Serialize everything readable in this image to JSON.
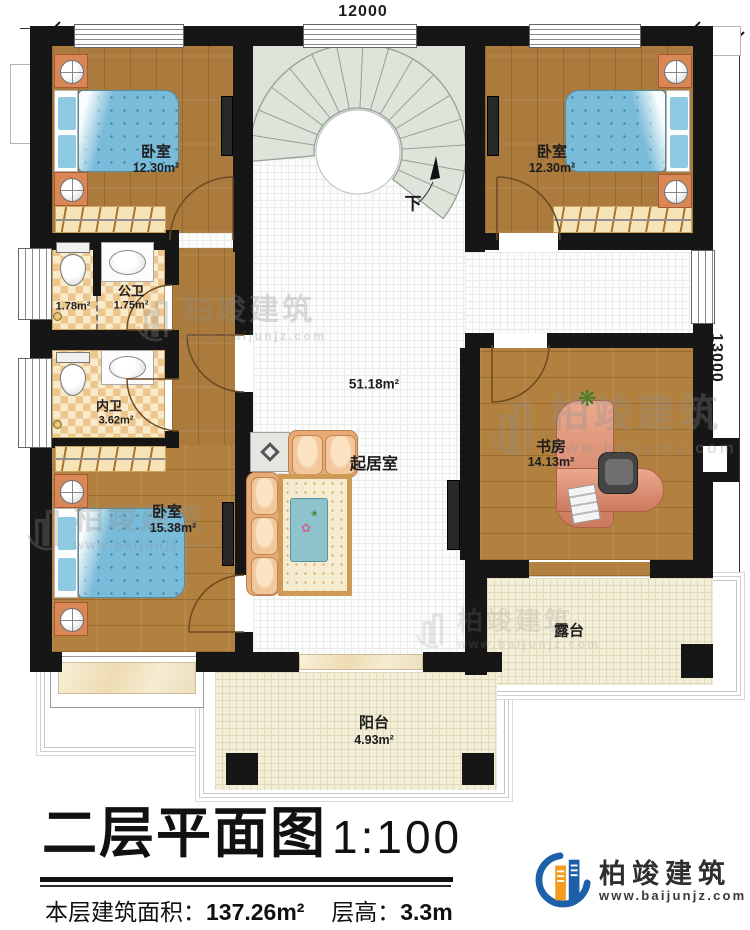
{
  "dimensions": {
    "top": "12000",
    "right": "13000"
  },
  "stairs": {
    "down": "下"
  },
  "rooms": {
    "bedroom_tl": {
      "name": "卧室",
      "area": "12.30m²"
    },
    "bedroom_tr": {
      "name": "卧室",
      "area": "12.30m²"
    },
    "bedroom_bl": {
      "name": "卧室",
      "area": "15.38m²"
    },
    "living": {
      "name": "起居室",
      "area": "51.18m²"
    },
    "study": {
      "name": "书房",
      "area": "14.13m²"
    },
    "public_bath": {
      "name": "公卫",
      "area": "1.75m²"
    },
    "toilet_stall": {
      "area": "1.78m²"
    },
    "ensuite_bath": {
      "name": "内卫",
      "area": "3.62m²"
    },
    "terrace": {
      "name": "露台"
    },
    "balcony": {
      "name": "阳台",
      "area": "4.93m²"
    }
  },
  "titleblock": {
    "title": "二层平面图",
    "scale": "1:100",
    "area_label": "本层建筑面积：",
    "area_value": "137.26m²",
    "height_label": "层高：",
    "height_value": "3.3m"
  },
  "brand": {
    "name": "柏竣建筑",
    "url": "www.baijunjz.com"
  },
  "watermark": {
    "name": "柏竣建筑",
    "url": "www.baijunjz.com"
  },
  "colors": {
    "wall": "#161616",
    "wood": "#ab7a3d",
    "bath_tile": "#ecc68d",
    "bed": "#79bcd9",
    "sofa": "#e8ab77",
    "stair": "#dde3d9",
    "brand_blue": "#1d5fa8",
    "brand_orange": "#f39c1f"
  }
}
